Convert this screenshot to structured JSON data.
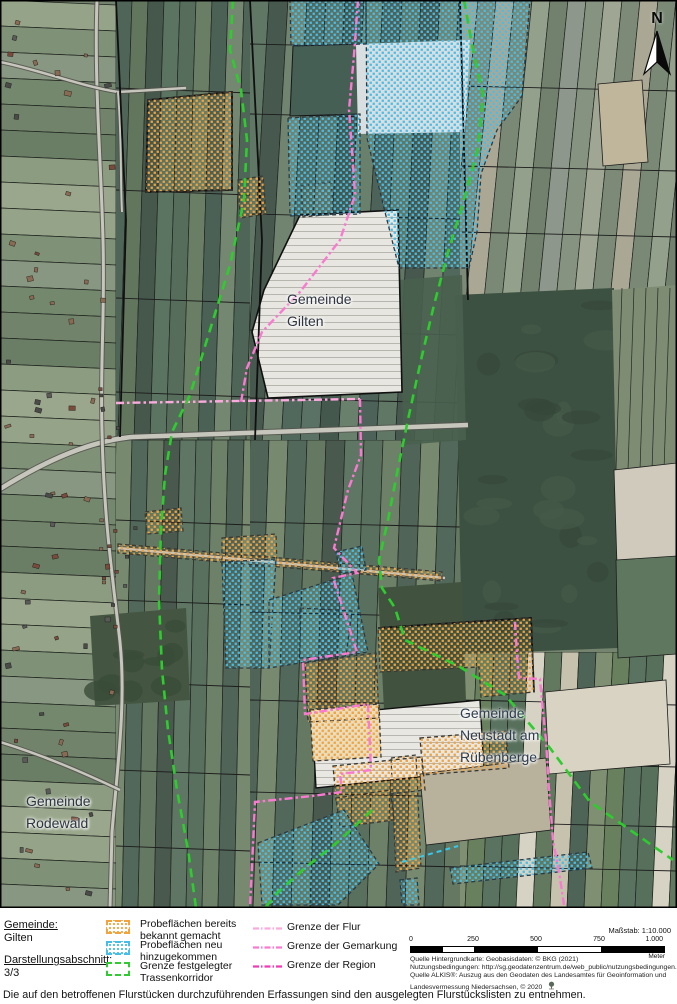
{
  "map": {
    "labels": {
      "gilten": {
        "line1": "Gemeinde",
        "line2": "Gilten"
      },
      "neustadt": {
        "line1": "Gemeinde",
        "line2": "Neustadt am",
        "line3": "Rübenberge"
      },
      "rodewald": {
        "line1": "Gemeinde",
        "line2": "Rodewald"
      }
    },
    "north": "N"
  },
  "info": {
    "gemeinde_label": "Gemeinde:",
    "gemeinde_value": "Gilten",
    "abschnitt_label": "Darstellungsabschnitt:",
    "abschnitt_value": "3/3"
  },
  "legend": {
    "areas": [
      {
        "line1": "Probeflächen bereits",
        "line2": "bekannt gemacht",
        "swatch_color": "#F2A33C"
      },
      {
        "line1": "Probeflächen neu",
        "line2": "hinzugekommen",
        "swatch_color": "#45BEEA"
      },
      {
        "line1": "Grenze festgelegter",
        "line2": "Trassenkorridor",
        "swatch_color": "#2ECC2E"
      }
    ],
    "lines": [
      {
        "label": "Grenze der Flur",
        "color": "#FBAADE"
      },
      {
        "label": "Grenze der Gemarkung",
        "color": "#FA7AD2"
      },
      {
        "label": "Grenze der Region",
        "color": "#F23BB3"
      }
    ]
  },
  "scale": {
    "label": "Maßstab: 1:10.000",
    "ticks": [
      "0",
      "250",
      "500",
      "750",
      "1.000"
    ],
    "unit": "Meter"
  },
  "attribution": [
    "Quelle Hintergrundkarte: Geobasisdaten: © BKG (2021)",
    "Nutzungsbedingungen: http://sg.geodatenzentrum.de/web_public/nutzungsbedingungen.pdf",
    "Quelle ALKIS®: Auszug aus den Geodaten des Landesamtes für Geoinformation und",
    "Landesvermessung Niedersachsen, © 2020"
  ],
  "footnote": "Die auf den betroffenen Flurstücken durchzuführenden Erfassungen sind den ausgelegten Flurstückslisten zu entnehmen.",
  "colors": {
    "probe_orange": "#F2A33C",
    "probe_blue": "#45BEEA",
    "korridor_green": "#2ECC2E",
    "grenze_flur": "#FBAADE",
    "grenze_gemarkung": "#FA7AD2",
    "grenze_region": "#F23BB3"
  }
}
